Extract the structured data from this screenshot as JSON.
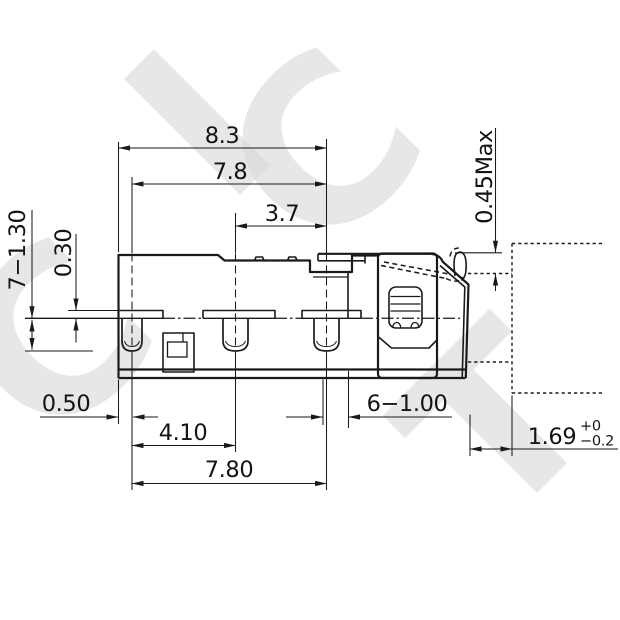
{
  "drawing": {
    "kind": "engineering dimension drawing",
    "subject": "detector switch side view with phantom mounting panel"
  },
  "watermark": {
    "letters": [
      {
        "ch": "C"
      },
      {
        "ch": "I"
      },
      {
        "ch": "C"
      },
      {
        "ch": "T"
      }
    ]
  },
  "dimensions": {
    "overall_width": "8.3",
    "outer_pin_span": "7.8",
    "inner_pin_span": "3.7",
    "lever_height_max": "0.45Max",
    "pin_length": "7−1.30",
    "shoulder_height": "0.30",
    "edge_to_first_pin": "0.50",
    "first_to_second_pin": "4.10",
    "first_to_third_pin": "7.80",
    "pin_width": "6−1.00",
    "panel_gap": {
      "value": "1.69",
      "tol_upper": "+0",
      "tol_lower": "−0.2"
    }
  }
}
